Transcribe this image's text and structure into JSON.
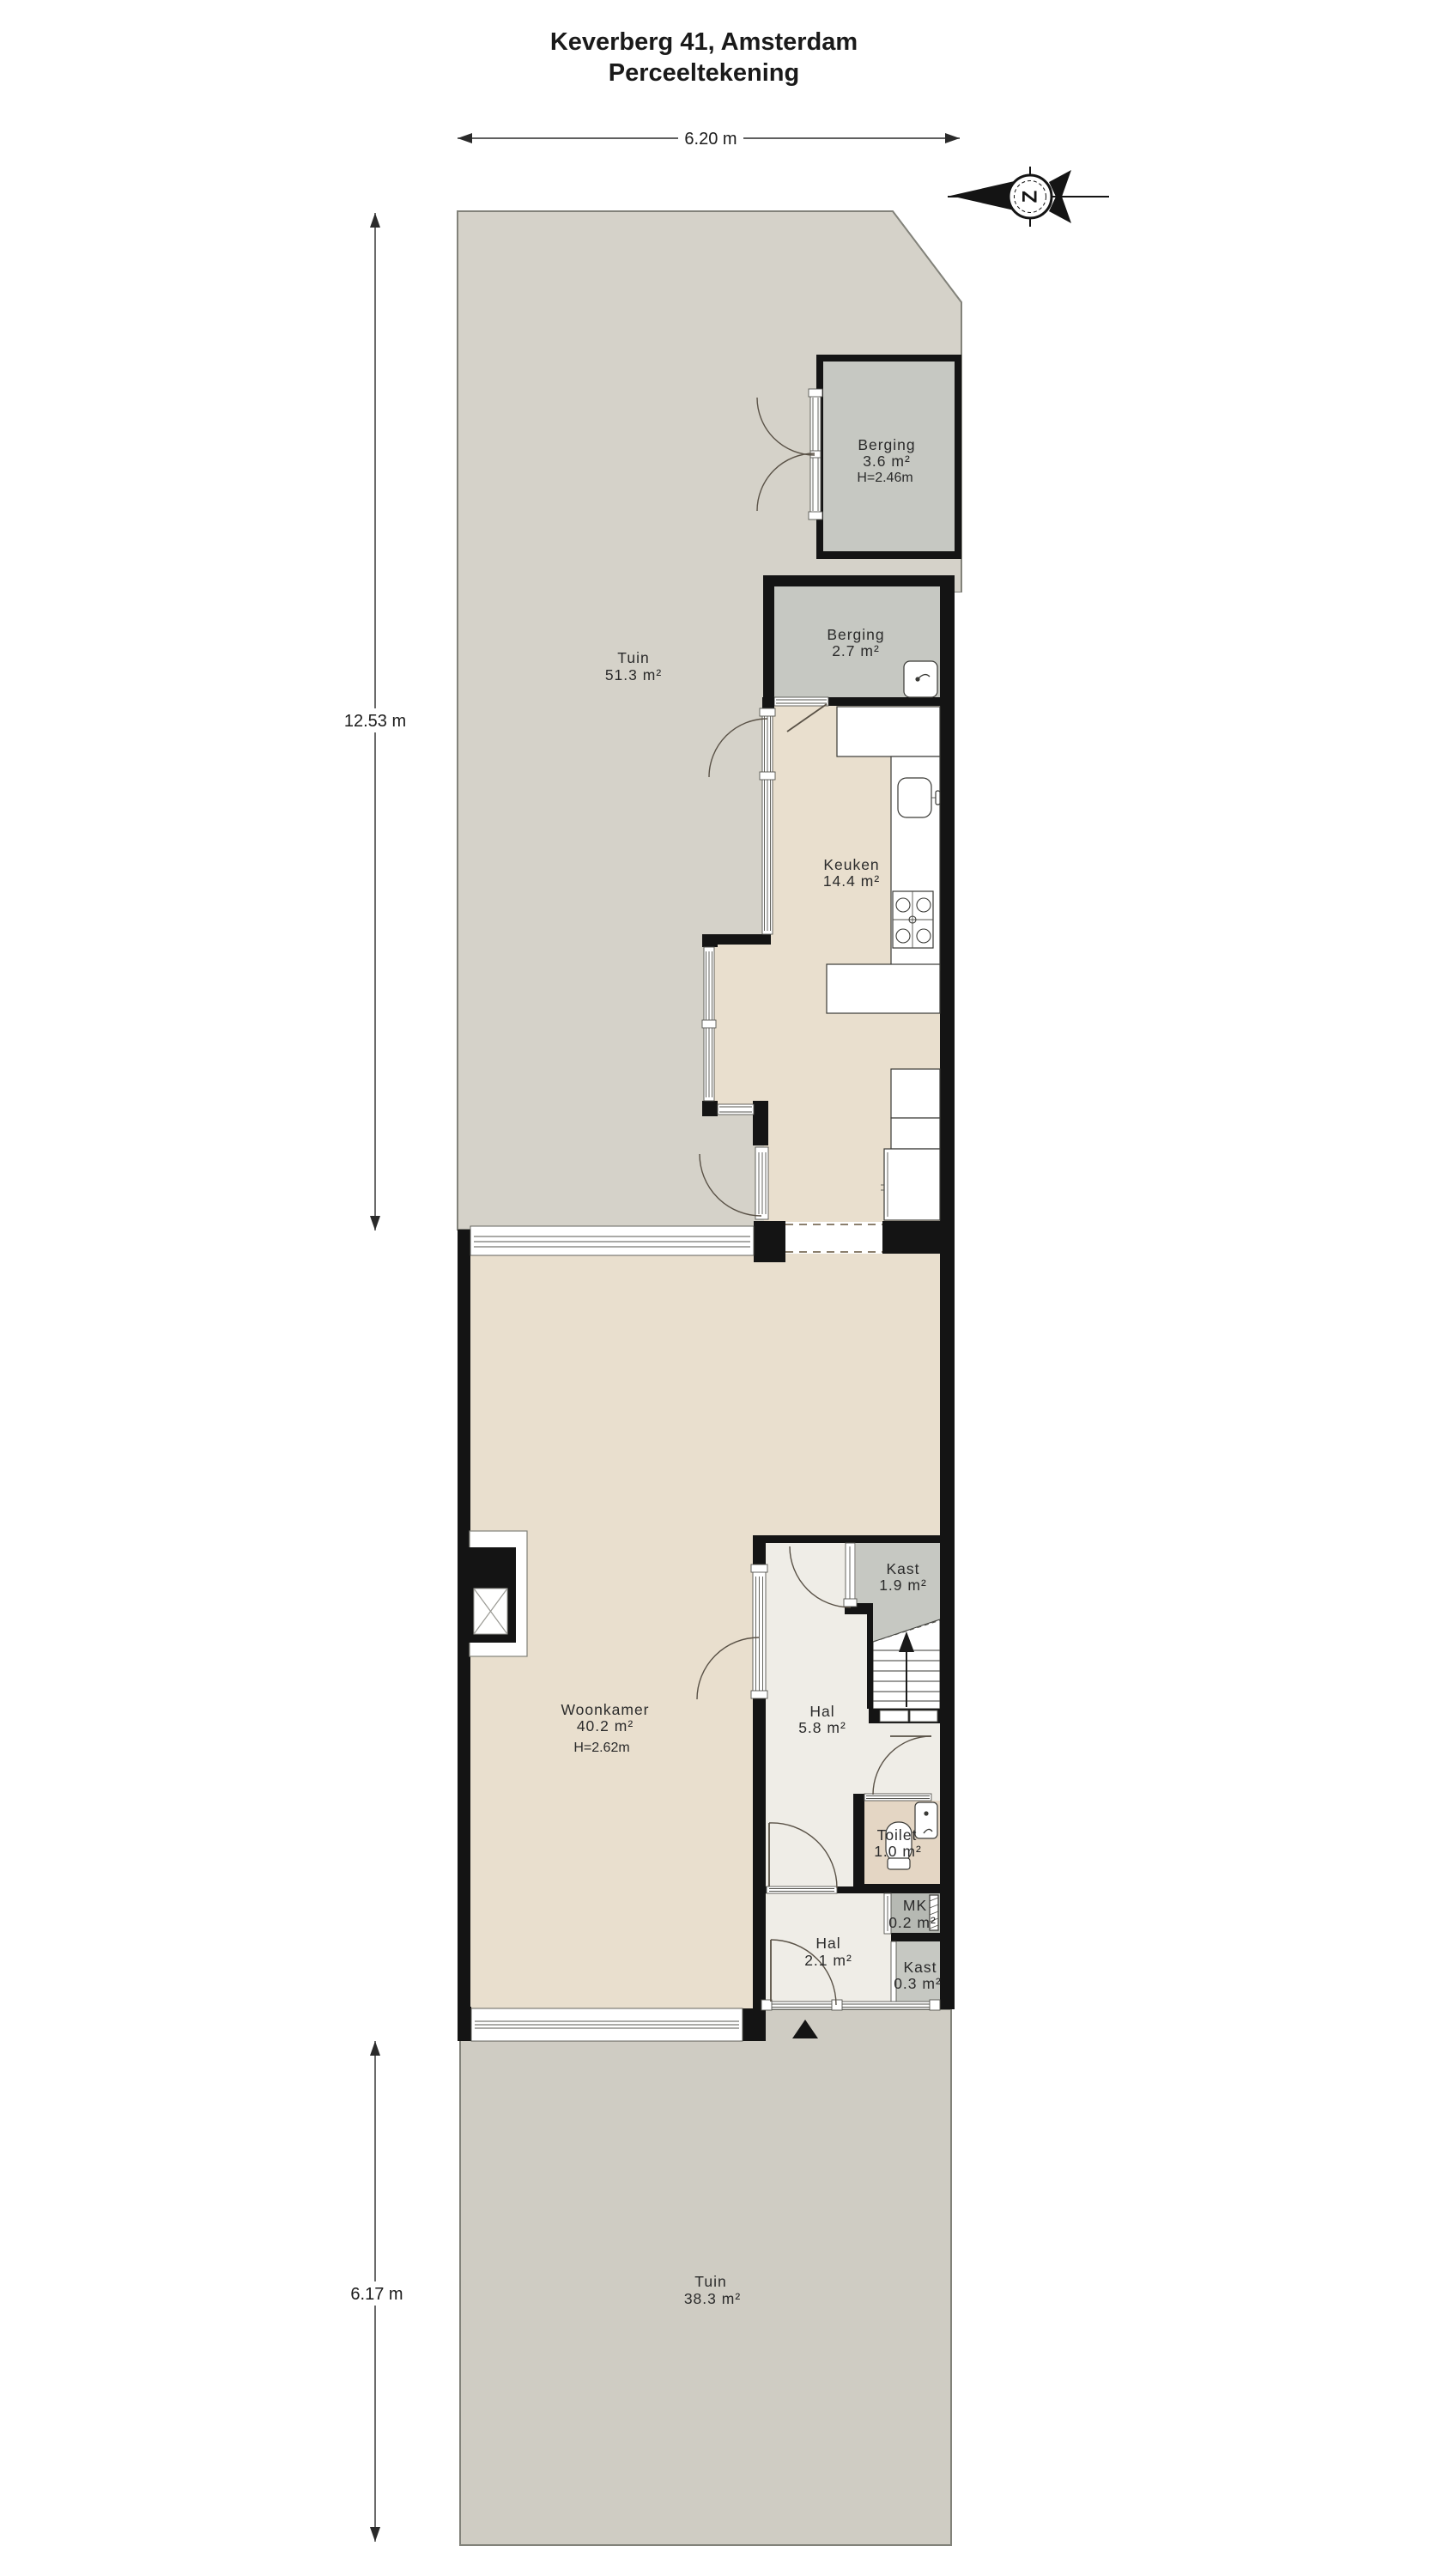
{
  "title": {
    "line1": "Keverberg 41, Amsterdam",
    "line2": "Perceeltekening"
  },
  "dimensions": {
    "width_top": "6.20 m",
    "height_upper": "12.53 m",
    "height_lower": "6.17 m"
  },
  "compass": {
    "letter": "Z"
  },
  "rooms": {
    "tuin_top": {
      "name": "Tuin",
      "area": "51.3 m²"
    },
    "berging_large": {
      "name": "Berging",
      "area": "3.6 m²",
      "ceiling": "H=2.46m"
    },
    "berging_small": {
      "name": "Berging",
      "area": "2.7 m²"
    },
    "keuken": {
      "name": "Keuken",
      "area": "14.4 m²"
    },
    "woonkamer": {
      "name": "Woonkamer",
      "area": "40.2 m²",
      "ceiling": "H=2.62m"
    },
    "kast_stairs": {
      "name": "Kast",
      "area": "1.9 m²"
    },
    "hal_main": {
      "name": "Hal",
      "area": "5.8 m²"
    },
    "toilet": {
      "name": "Toilet",
      "area": "1.0 m²"
    },
    "mk": {
      "name": "MK",
      "area": "0.2 m²"
    },
    "hal_entry": {
      "name": "Hal",
      "area": "2.1 m²"
    },
    "kast_entry": {
      "name": "Kast",
      "area": "0.3 m²"
    },
    "tuin_bottom": {
      "name": "Tuin",
      "area": "38.3 m²"
    }
  },
  "colors": {
    "wall": "#141414",
    "garden_top": "#d5d2c9",
    "garden_bottom": "#cfccc3",
    "floor_main": "#e9dfce",
    "floor_hal": "#efede7",
    "floor_toilet": "#e4d6c4",
    "storage": "#c6c8c2",
    "storage_dark": "#b6b9b3"
  }
}
